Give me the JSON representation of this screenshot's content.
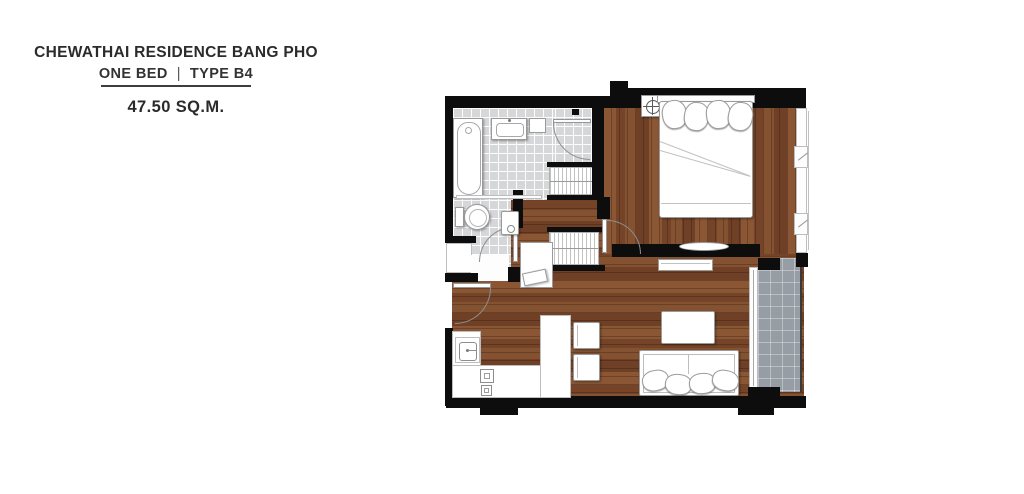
{
  "header": {
    "title": "CHEWATHAI RESIDENCE BANG PHO",
    "unit_type": "ONE BED",
    "separator": "|",
    "type_code": "TYPE B4",
    "area": "47.50 SQ.M."
  },
  "colors": {
    "background": "#ffffff",
    "wall": "#0d0d0d",
    "wood_floor": "#7d4a2b",
    "bathroom_tile": "#d6d7d9",
    "balcony_tile": "#979da5",
    "furniture": "#ffffff",
    "text": "#2b2b2b"
  },
  "plan_elements": [
    "bathtub",
    "wash-basin",
    "toilet",
    "shower-panel",
    "glass-partition",
    "wardrobe",
    "wardrobe",
    "dressing-table",
    "stool",
    "double-bed",
    "pillows",
    "nightstand-lamp",
    "bedroom-tv-shelf",
    "tv-console",
    "coffee-table",
    "sofa",
    "kitchen-counter",
    "kitchen-sink",
    "stove",
    "bar-chair",
    "bar-chair",
    "balcony",
    "sliding-door",
    "window",
    "window",
    "entry-door",
    "bathroom-door",
    "toilet-door",
    "bedroom-door"
  ]
}
